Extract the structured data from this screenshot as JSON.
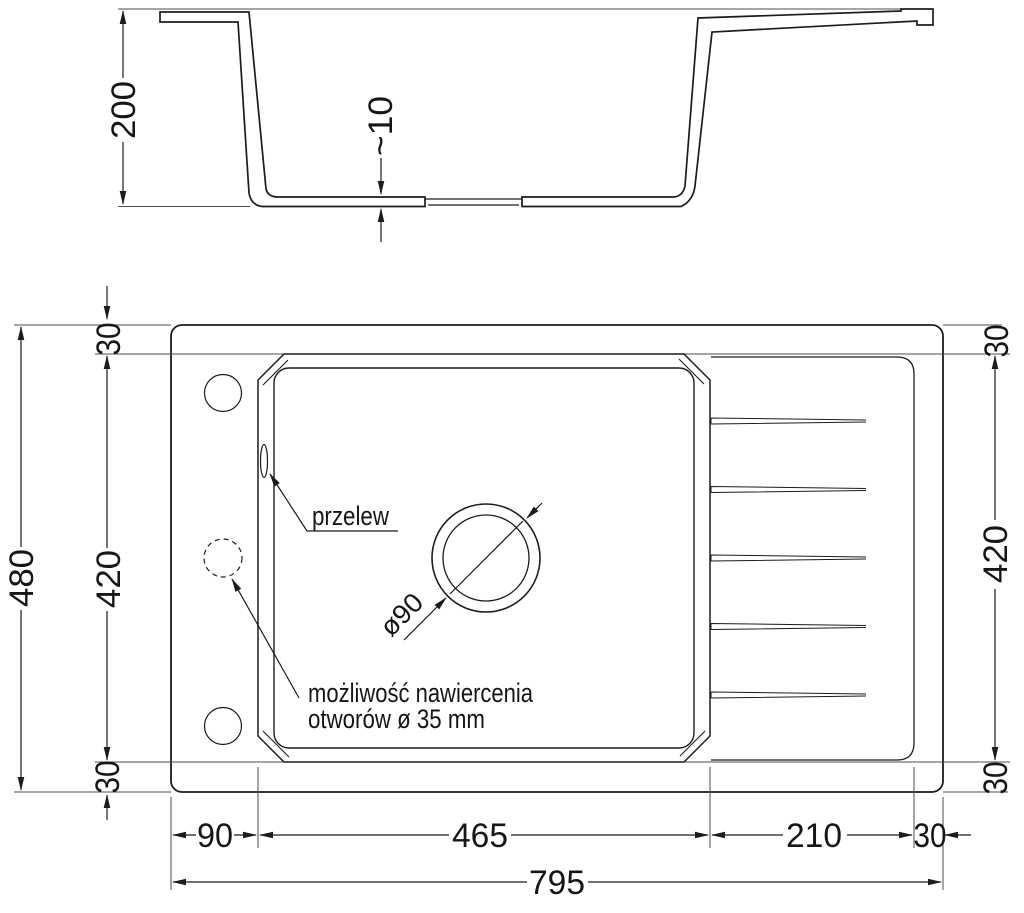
{
  "drawing_type": "sink technical dimension drawing",
  "colors": {
    "line": "#1c1c1c",
    "background": "#ffffff"
  },
  "section": {
    "height": "200",
    "base_thickness": "~10"
  },
  "plan": {
    "left": {
      "total_height": "480",
      "inner_height": "420",
      "top_margin": "30",
      "bottom_margin": "30"
    },
    "right": {
      "top_margin": "30",
      "inner_height": "420",
      "bottom_margin": "30"
    },
    "bottom": {
      "left_margin": "90",
      "bowl_width": "465",
      "drainer_width": "210",
      "right_margin": "30",
      "total_width": "795"
    },
    "labels": {
      "overflow": "przelew",
      "drain_diameter": "ø90",
      "note_line1": "możliwość nawiercenia",
      "note_line2": "otworów ø 35 mm"
    }
  }
}
